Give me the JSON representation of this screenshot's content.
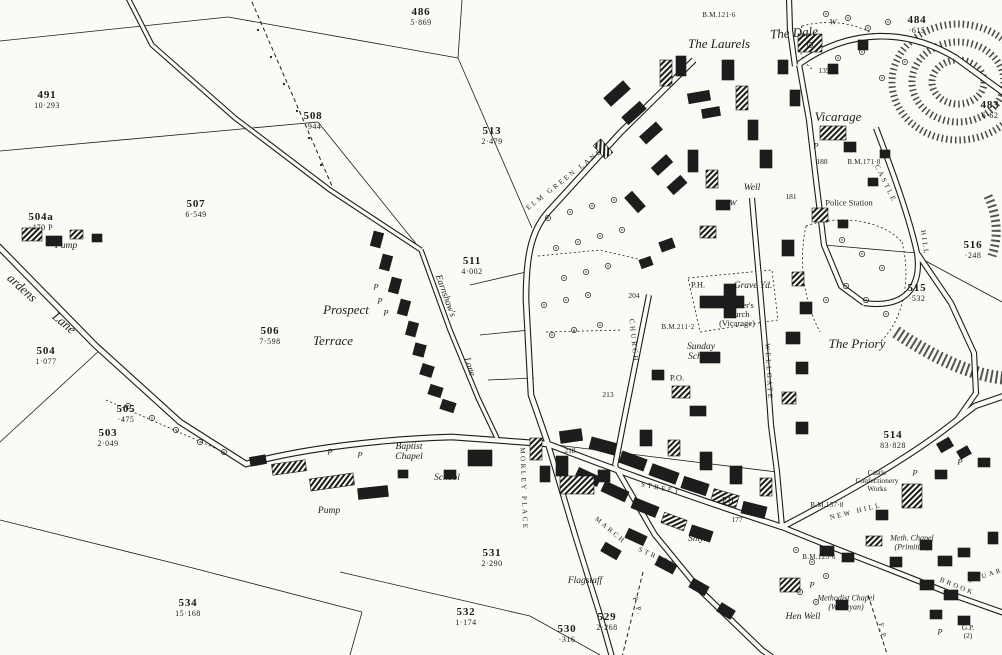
{
  "map": {
    "paper_color": "#fbfaf5",
    "ink_color": "#1c1c1c",
    "labels": [
      {
        "lines": [
          "486",
          "5·869"
        ],
        "x": 421,
        "y": 17,
        "c": "p",
        "n": "parcel-486"
      },
      {
        "lines": [
          "491",
          "10·293"
        ],
        "x": 47,
        "y": 100,
        "c": "p",
        "n": "parcel-491"
      },
      {
        "lines": [
          "508",
          "·944"
        ],
        "x": 313,
        "y": 121,
        "c": "p",
        "n": "parcel-508"
      },
      {
        "lines": [
          "513",
          "2·479"
        ],
        "x": 492,
        "y": 136,
        "c": "p",
        "n": "parcel-513"
      },
      {
        "lines": [
          "507",
          "6·549"
        ],
        "x": 196,
        "y": 209,
        "c": "p",
        "n": "parcel-507"
      },
      {
        "lines": [
          "511",
          "4·002"
        ],
        "x": 472,
        "y": 266,
        "c": "p",
        "n": "parcel-511"
      },
      {
        "lines": [
          "506",
          "7·598"
        ],
        "x": 270,
        "y": 336,
        "c": "p",
        "n": "parcel-506"
      },
      {
        "lines": [
          "504a",
          "·470  P"
        ],
        "x": 41,
        "y": 222,
        "c": "p",
        "n": "parcel-504a"
      },
      {
        "lines": [
          "504",
          "1·077"
        ],
        "x": 46,
        "y": 356,
        "c": "p",
        "n": "parcel-504"
      },
      {
        "lines": [
          "505",
          "·475"
        ],
        "x": 126,
        "y": 414,
        "c": "p",
        "n": "parcel-505"
      },
      {
        "lines": [
          "503",
          "2·049"
        ],
        "x": 108,
        "y": 438,
        "c": "p",
        "n": "parcel-503"
      },
      {
        "lines": [
          "534",
          "15·168"
        ],
        "x": 188,
        "y": 608,
        "c": "p",
        "n": "parcel-534"
      },
      {
        "lines": [
          "531",
          "2·290"
        ],
        "x": 492,
        "y": 558,
        "c": "p",
        "n": "parcel-531"
      },
      {
        "lines": [
          "532",
          "1·174"
        ],
        "x": 466,
        "y": 617,
        "c": "p",
        "n": "parcel-532"
      },
      {
        "lines": [
          "530",
          "·316"
        ],
        "x": 567,
        "y": 634,
        "c": "p",
        "n": "parcel-530"
      },
      {
        "lines": [
          "529",
          "2·268"
        ],
        "x": 607,
        "y": 622,
        "c": "p",
        "n": "parcel-529"
      },
      {
        "lines": [
          "514",
          "83·828"
        ],
        "x": 893,
        "y": 440,
        "c": "p",
        "n": "parcel-514"
      },
      {
        "lines": [
          "515",
          "·532"
        ],
        "x": 917,
        "y": 293,
        "c": "p",
        "n": "parcel-515"
      },
      {
        "lines": [
          "516",
          "·248"
        ],
        "x": 973,
        "y": 250,
        "c": "p",
        "n": "parcel-516"
      },
      {
        "lines": [
          "484",
          "·615"
        ],
        "x": 917,
        "y": 25,
        "c": "p",
        "n": "parcel-484"
      },
      {
        "lines": [
          "483",
          "6·62"
        ],
        "x": 990,
        "y": 110,
        "c": "p",
        "n": "parcel-483"
      },
      {
        "t": "135",
        "x": 824,
        "y": 71,
        "c": "sp",
        "n": "parcel-135"
      },
      {
        "t": "188",
        "x": 822,
        "y": 162,
        "c": "sp",
        "n": "spot-height"
      },
      {
        "t": "181",
        "x": 791,
        "y": 197,
        "c": "sp",
        "n": "spot-height"
      },
      {
        "t": "204",
        "x": 634,
        "y": 296,
        "c": "sp",
        "n": "spot-height"
      },
      {
        "t": "213",
        "x": 608,
        "y": 395,
        "c": "sp",
        "n": "spot-height"
      },
      {
        "t": "218",
        "x": 570,
        "y": 451,
        "c": "sp",
        "n": "spot-height"
      },
      {
        "t": "177",
        "x": 737,
        "y": 520,
        "c": "sp",
        "n": "spot-height"
      },
      {
        "t": "B.M.121·6",
        "x": 719,
        "y": 16,
        "c": "bm",
        "n": "benchmark"
      },
      {
        "t": "B.M.171·8",
        "x": 864,
        "y": 163,
        "c": "bm",
        "n": "benchmark"
      },
      {
        "t": "B.M.211·2",
        "x": 678,
        "y": 328,
        "c": "bm",
        "n": "benchmark"
      },
      {
        "t": "B.M.157·8",
        "x": 827,
        "y": 506,
        "c": "bm",
        "n": "benchmark"
      },
      {
        "t": "B.M.125·6",
        "x": 819,
        "y": 558,
        "c": "bm",
        "n": "benchmark"
      },
      {
        "t": "The Dale",
        "x": 794,
        "y": 33,
        "r": -4,
        "c": "nl",
        "n": "place-the-dale"
      },
      {
        "t": "The Laurels",
        "x": 719,
        "y": 44,
        "c": "nl",
        "n": "place-the-laurels"
      },
      {
        "t": "Vicarage",
        "x": 838,
        "y": 117,
        "c": "nl",
        "n": "place-vicarage"
      },
      {
        "t": "The Priory",
        "x": 857,
        "y": 344,
        "c": "nl",
        "n": "place-the-priory"
      },
      {
        "t": "Prospect",
        "x": 346,
        "y": 310,
        "c": "nl",
        "n": "place-prospect-terrace"
      },
      {
        "t": "Terrace",
        "x": 333,
        "y": 341,
        "c": "nl",
        "n": "place-prospect-terrace"
      },
      {
        "t": "Grave Yd.",
        "x": 753,
        "y": 286,
        "c": "nm",
        "n": "poi-grave-yard"
      },
      {
        "t": "Well",
        "x": 752,
        "y": 188,
        "c": "nm",
        "n": "poi-well"
      },
      {
        "t": "W",
        "x": 733,
        "y": 203,
        "c": "py",
        "n": "well-marker"
      },
      {
        "t": "W",
        "x": 833,
        "y": 22,
        "c": "py",
        "n": "well-marker"
      },
      {
        "lines": [
          "Sunday",
          "School"
        ],
        "x": 701,
        "y": 352,
        "c": "nm",
        "n": "poi-sunday-school"
      },
      {
        "t": "P.O.",
        "x": 677,
        "y": 378,
        "c": "ro",
        "n": "poi-post-office"
      },
      {
        "t": "P.H.",
        "x": 698,
        "y": 285,
        "c": "ro",
        "n": "poi-public-house"
      },
      {
        "t": "P.H.",
        "x": 729,
        "y": 500,
        "c": "ro",
        "n": "poi-public-house"
      },
      {
        "t": "Smy.",
        "x": 697,
        "y": 539,
        "c": "nm",
        "n": "poi-smithy"
      },
      {
        "lines": [
          "Baptist",
          "Chapel"
        ],
        "x": 409,
        "y": 452,
        "c": "nm",
        "n": "poi-baptist-chapel"
      },
      {
        "t": "School",
        "x": 447,
        "y": 478,
        "c": "nm",
        "n": "poi-school"
      },
      {
        "t": "Pump",
        "x": 66,
        "y": 246,
        "c": "nm",
        "n": "poi-pump"
      },
      {
        "t": "Pump",
        "x": 329,
        "y": 511,
        "c": "nm",
        "n": "poi-pump"
      },
      {
        "t": "Flagstaff",
        "x": 585,
        "y": 581,
        "c": "nm",
        "n": "poi-flagstaff"
      },
      {
        "t": "Police Station",
        "x": 849,
        "y": 203,
        "c": "ro",
        "n": "poi-police-station"
      },
      {
        "lines": [
          "St. Peter's",
          "Church",
          "(Vicarage)"
        ],
        "x": 737,
        "y": 315,
        "c": "ro",
        "n": "poi-st-peters-church"
      },
      {
        "lines": [
          "Castle",
          "Confectionery",
          "Works"
        ],
        "x": 877,
        "y": 481,
        "c": "ro2",
        "n": "poi-castle-confectionery-works"
      },
      {
        "lines": [
          "Methodist Chapel",
          "(Wesleyan)"
        ],
        "x": 846,
        "y": 603,
        "c": "nm2",
        "n": "poi-methodist-chapel-wesleyan"
      },
      {
        "lines": [
          "Meth. Chapel",
          "(Primitive)"
        ],
        "x": 912,
        "y": 543,
        "c": "nm2",
        "n": "poi-methodist-chapel-primitive"
      },
      {
        "t": "Hen Well",
        "x": 803,
        "y": 617,
        "c": "nm",
        "n": "poi-hen-well"
      },
      {
        "lines": [
          "G.P.",
          "(2)"
        ],
        "x": 968,
        "y": 632,
        "c": "ro2",
        "n": "poi-guide-post"
      },
      {
        "t": "ELM GREEN LANE",
        "x": 565,
        "y": 180,
        "r": -38,
        "c": "st",
        "n": "street-elm-green-lane"
      },
      {
        "t": "CASTLE",
        "x": 885,
        "y": 184,
        "r": 64,
        "c": "st",
        "n": "street-castle-hill"
      },
      {
        "t": "HILL",
        "x": 924,
        "y": 243,
        "r": 82,
        "c": "st",
        "n": "street-castle-hill"
      },
      {
        "t": "NEW HILL",
        "x": 856,
        "y": 512,
        "r": -14,
        "c": "st",
        "n": "street-new-hill"
      },
      {
        "t": "MORLEY PLACE",
        "x": 523,
        "y": 489,
        "r": 88,
        "c": "st",
        "n": "street-morley-place"
      },
      {
        "t": "MARCH",
        "x": 610,
        "y": 531,
        "r": 40,
        "c": "st",
        "n": "street-march"
      },
      {
        "t": "STREET",
        "x": 657,
        "y": 558,
        "r": 24,
        "c": "st",
        "n": "street-label"
      },
      {
        "t": "STREET",
        "x": 661,
        "y": 489,
        "r": 11,
        "c": "st",
        "n": "street-label"
      },
      {
        "t": "CHURCH",
        "x": 633,
        "y": 341,
        "r": 84,
        "c": "st",
        "n": "street-church"
      },
      {
        "t": "WELLGATE",
        "x": 768,
        "y": 372,
        "r": 87,
        "c": "st",
        "n": "street-wellgate"
      },
      {
        "t": "BROOK",
        "x": 957,
        "y": 587,
        "r": 22,
        "c": "st",
        "n": "street-brook-square"
      },
      {
        "t": "SQUARE",
        "x": 989,
        "y": 575,
        "r": -18,
        "c": "st",
        "n": "street-brook-square"
      },
      {
        "t": "F.P.",
        "x": 637,
        "y": 607,
        "r": 72,
        "c": "st",
        "n": "footpath-label"
      },
      {
        "t": "F.P.",
        "x": 882,
        "y": 633,
        "r": 78,
        "c": "st",
        "n": "footpath-label"
      },
      {
        "t": "Earnshaw's",
        "x": 445,
        "y": 296,
        "r": 70,
        "c": "nm",
        "n": "street-earnshaws-lane"
      },
      {
        "t": "Lane",
        "x": 469,
        "y": 367,
        "r": 72,
        "c": "nm",
        "n": "street-earnshaws-lane"
      },
      {
        "t": "ardens",
        "x": 22,
        "y": 288,
        "r": 42,
        "c": "nl",
        "n": "street-gardens-lane"
      },
      {
        "t": "Lane",
        "x": 64,
        "y": 323,
        "r": 40,
        "c": "nl",
        "n": "street-gardens-lane"
      },
      {
        "t": "P",
        "x": 376,
        "y": 287,
        "c": "py",
        "n": "pump-marker"
      },
      {
        "t": "P",
        "x": 380,
        "y": 301,
        "c": "py",
        "n": "pump-marker"
      },
      {
        "t": "P",
        "x": 386,
        "y": 313,
        "c": "py",
        "n": "pump-marker"
      },
      {
        "t": "P",
        "x": 330,
        "y": 452,
        "c": "py",
        "n": "pump-marker"
      },
      {
        "t": "P",
        "x": 360,
        "y": 455,
        "c": "py",
        "n": "pump-marker"
      },
      {
        "t": "P",
        "x": 816,
        "y": 146,
        "c": "py",
        "n": "pump-marker"
      },
      {
        "t": "P",
        "x": 915,
        "y": 473,
        "c": "py",
        "n": "pump-marker"
      },
      {
        "t": "P",
        "x": 960,
        "y": 462,
        "c": "py",
        "n": "pump-marker"
      },
      {
        "t": "P",
        "x": 940,
        "y": 632,
        "c": "py",
        "n": "pump-marker"
      },
      {
        "t": "P",
        "x": 812,
        "y": 585,
        "c": "py",
        "n": "pump-marker"
      }
    ]
  }
}
